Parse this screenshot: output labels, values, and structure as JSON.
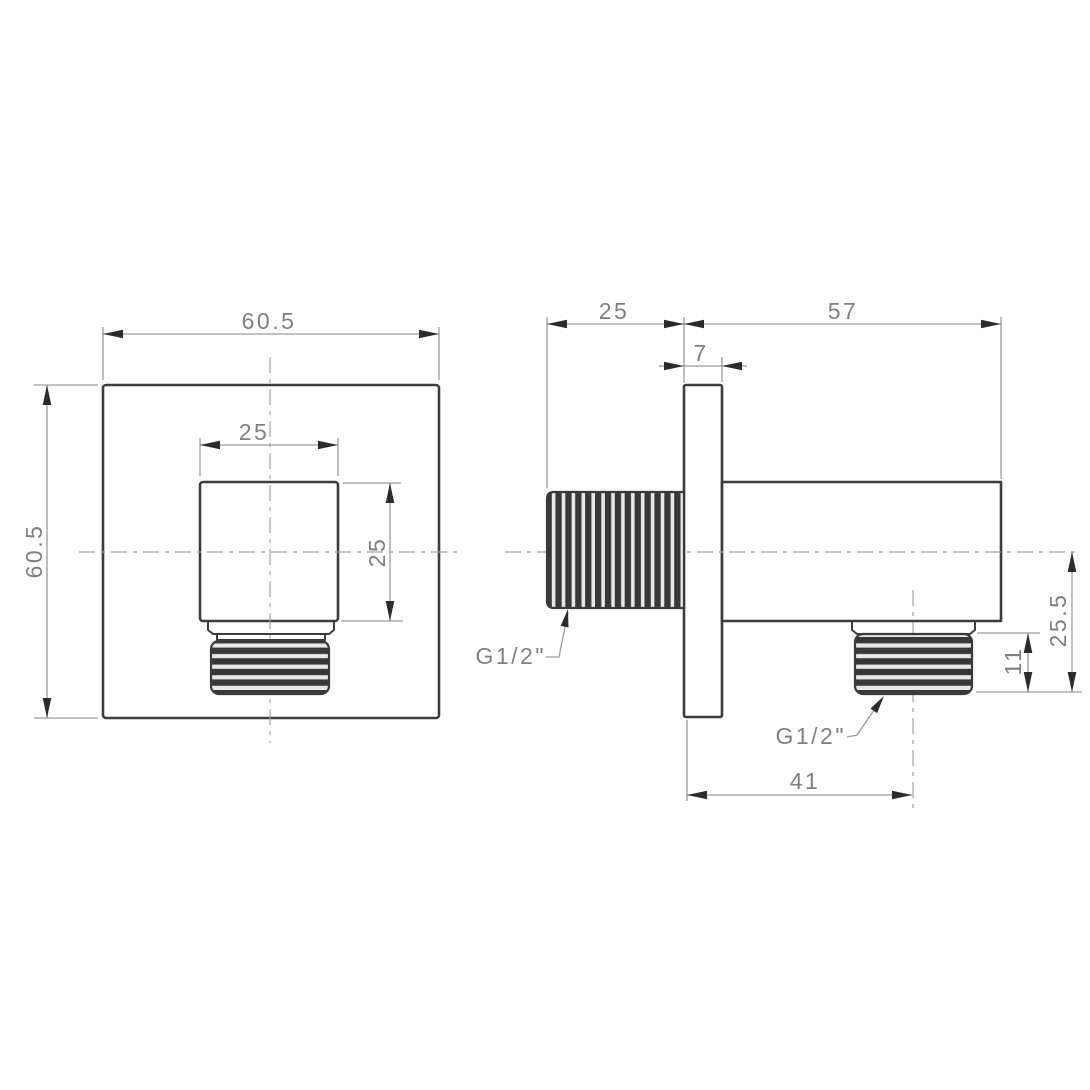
{
  "drawing": {
    "kind": "technical-drawing",
    "subject": "square wall outlet elbow, two-view dimensioned drawing",
    "colors": {
      "background": "#ffffff",
      "part_outline": "#3c3c3c",
      "dimension_line": "#9c9c9c",
      "centerline": "#a3a3a3",
      "arrowhead": "#2b2b2b",
      "text": "#7f7f7f",
      "thread_dark": "#383838",
      "thread_light": "#e8e8e8"
    },
    "front_view": {
      "overall_width": "60.5",
      "overall_height": "60.5",
      "boss_width": "25",
      "boss_height": "25"
    },
    "side_view": {
      "inlet_thread_length": "25",
      "body_length": "57",
      "plate_thickness": "7",
      "outlet_drop_from_axis": "25.5",
      "outlet_thread_length": "11",
      "outlet_axis_offset": "41",
      "inlet_thread_spec": "G1/2\"",
      "outlet_thread_spec": "G1/2\""
    }
  }
}
